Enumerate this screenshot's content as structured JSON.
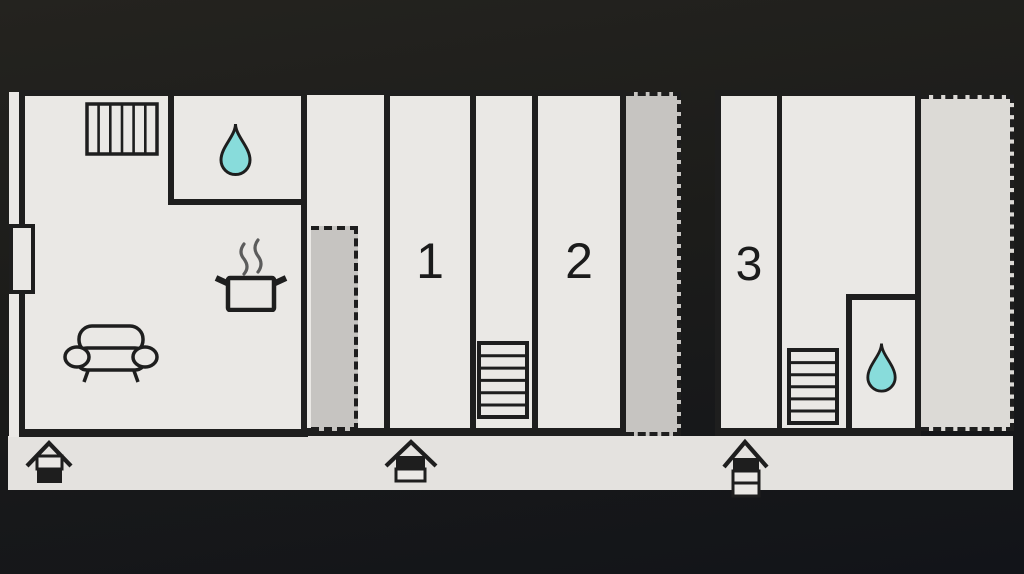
{
  "plan": {
    "title": "apartment floor plan",
    "units": [
      {
        "label": "1"
      },
      {
        "label": "2"
      },
      {
        "label": "3"
      }
    ],
    "icons": [
      "radiator-icon",
      "water-drop-icon",
      "cooking-pot-icon",
      "sofa-icon",
      "stairs-icon",
      "entrance-house-icon",
      "window-marker",
      "terrace-dashed-area"
    ]
  },
  "colors": {
    "bg_top": "#24231f",
    "bg_bottom": "#121419",
    "floor": "#eae8e5",
    "floor_strip": "#e4e2df",
    "terrace_gray": "#c6c4c1",
    "terrace_light": "#dcdad6",
    "wall": "#1e1e1e",
    "drop": "#88dcdb",
    "steam": "#5c5c5c",
    "digit": "#1b1b1b"
  }
}
